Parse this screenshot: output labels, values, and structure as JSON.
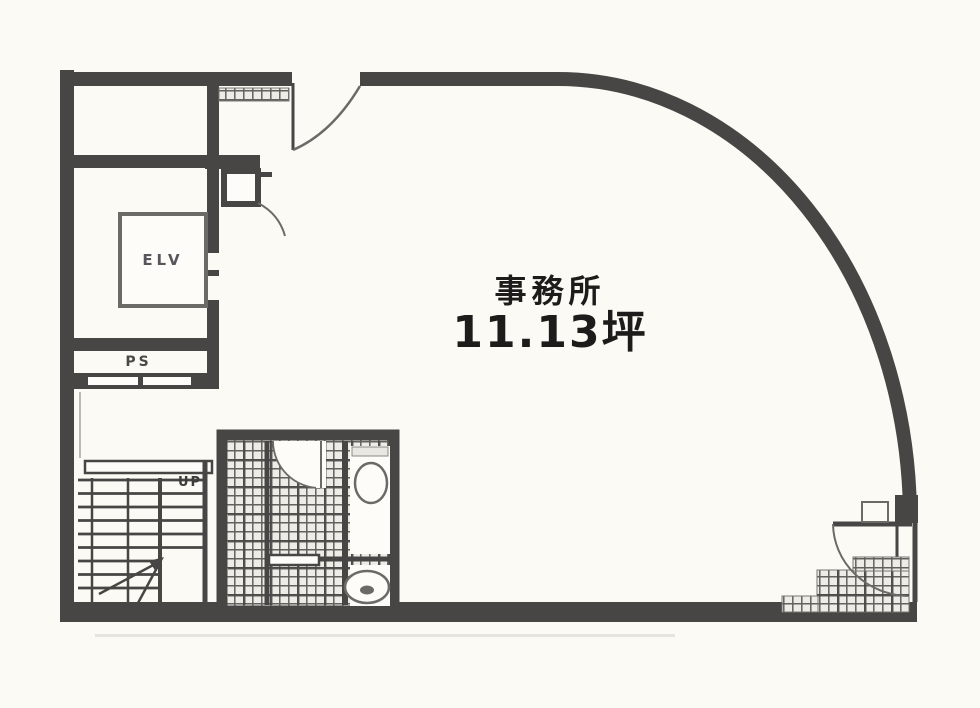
{
  "plan": {
    "room_label": "事務所",
    "area_label": "11.13坪",
    "elevator_label": "ELV",
    "pipe_shaft_label": "PS",
    "stairs_direction_label": "UP"
  },
  "colors": {
    "wall": "#474644",
    "wall_soft": "#6b6a67",
    "paper": "#fdfcf9",
    "bg": "#fcfaf5",
    "hatch": "#62615e",
    "hatch_bg": "#edece7",
    "ink": "#1d1c1a"
  }
}
